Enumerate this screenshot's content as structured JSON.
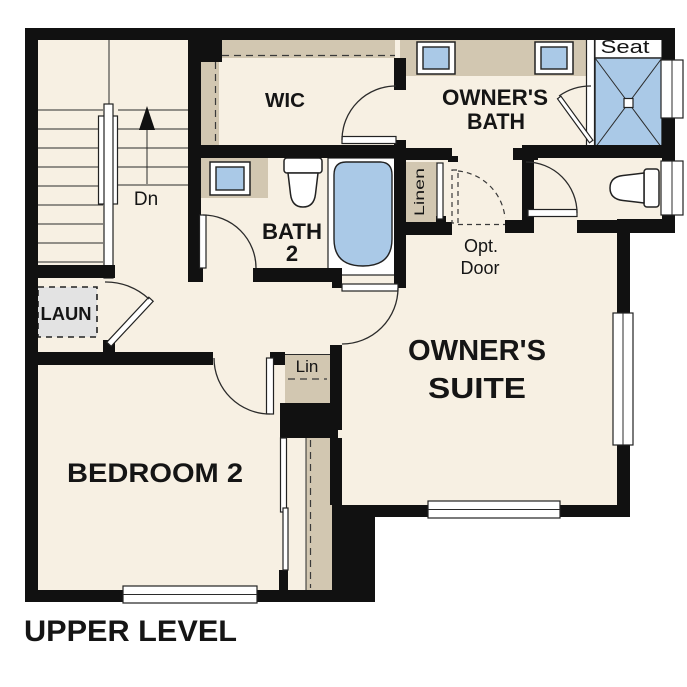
{
  "plan_title": "UPPER LEVEL",
  "rooms": {
    "owners_suite": {
      "line1": "OWNER'S",
      "line2": "SUITE"
    },
    "owners_bath": {
      "line1": "OWNER'S",
      "line2": "BATH"
    },
    "bedroom_2": {
      "label": "BEDROOM 2"
    },
    "bath_2": {
      "line1": "BATH",
      "line2": "2"
    },
    "wic": {
      "label": "WIC"
    },
    "laundry": {
      "label": "LAUN"
    },
    "stairs": {
      "direction_label": "Dn"
    }
  },
  "closets": {
    "linen_large": {
      "label": "Linen"
    },
    "linen_small": {
      "label": "Lin"
    }
  },
  "fixtures": {
    "shower_seat": {
      "label": "Seat"
    }
  },
  "annotations": {
    "optional_door": {
      "line1": "Opt.",
      "line2": "Door"
    }
  },
  "colors": {
    "background": "#ffffff",
    "floor": "#f7f0e3",
    "wall": "#111111",
    "cabinet_tan": "#d2c7b1",
    "fixture_blue": "#aac9e7",
    "laundry_gray": "#e3e3e3",
    "text": "#151515"
  }
}
